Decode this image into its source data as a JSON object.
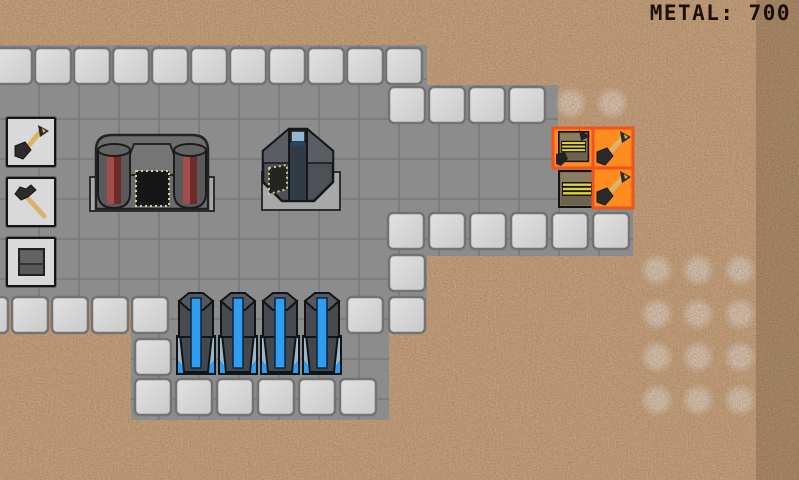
{
  "hud": {
    "metal_label": "METAL:",
    "metal_value": "700"
  },
  "colors": {
    "dirt": "#6b4a28",
    "floor": "#8c8c8c",
    "wall": "#d9d9d9",
    "order_fill": "#ff8c1e",
    "order_border": "#f1531f",
    "liquid_blue": "#2e9df2",
    "ore_gray": "#b8b8bd",
    "factory_red": "#a34c4c",
    "conveyor_yellow": "#e3d42f"
  },
  "toolbar": {
    "buttons": [
      {
        "id": "dig-tool",
        "icon": "shovel-icon"
      },
      {
        "id": "build-tool",
        "icon": "hammer-icon"
      },
      {
        "id": "wall-tool",
        "icon": "block-icon"
      }
    ]
  },
  "world": {
    "wall_rows": [
      {
        "x": -4,
        "y": 48,
        "n": 11,
        "pitch": 39
      },
      {
        "x": 389,
        "y": 87,
        "n": 4,
        "pitch": 40
      },
      {
        "x": 388,
        "y": 213,
        "n": 6,
        "pitch": 41
      },
      {
        "x": -28,
        "y": 297,
        "n": 5,
        "pitch": 40
      },
      {
        "x": 135,
        "y": 339,
        "n": 1,
        "pitch": 40
      },
      {
        "x": 135,
        "y": 379,
        "n": 6,
        "pitch": 41
      },
      {
        "x": 347,
        "y": 297,
        "n": 2,
        "pitch": 42
      },
      {
        "x": 389,
        "y": 255,
        "n": 1,
        "pitch": 40
      }
    ],
    "floor_rects": [
      {
        "x": 0,
        "y": 45,
        "w": 427,
        "h": 256
      },
      {
        "x": 385,
        "y": 85,
        "w": 173,
        "h": 130
      },
      {
        "x": 383,
        "y": 208,
        "w": 250,
        "h": 48
      },
      {
        "x": 131,
        "y": 294,
        "w": 258,
        "h": 126
      },
      {
        "x": 553,
        "y": 166,
        "w": 40,
        "h": 47
      }
    ],
    "ore_deposits": [
      {
        "x": 571,
        "y": 103
      },
      {
        "x": 612,
        "y": 103
      },
      {
        "x": 657,
        "y": 270
      },
      {
        "x": 698,
        "y": 270
      },
      {
        "x": 740,
        "y": 270
      },
      {
        "x": 657,
        "y": 314
      },
      {
        "x": 698,
        "y": 314
      },
      {
        "x": 740,
        "y": 314
      },
      {
        "x": 657,
        "y": 357
      },
      {
        "x": 698,
        "y": 357
      },
      {
        "x": 740,
        "y": 357
      },
      {
        "x": 657,
        "y": 400
      },
      {
        "x": 698,
        "y": 400
      },
      {
        "x": 740,
        "y": 400
      }
    ],
    "tanks": [
      {
        "x": 175,
        "y": 290
      },
      {
        "x": 217,
        "y": 290
      },
      {
        "x": 259,
        "y": 290
      },
      {
        "x": 301,
        "y": 290
      }
    ],
    "buildings": [
      {
        "type": "factory",
        "x": 88,
        "y": 130
      },
      {
        "type": "core",
        "x": 256,
        "y": 126
      },
      {
        "type": "conveyor",
        "x": 558,
        "y": 170
      }
    ],
    "build_orders": [
      {
        "type": "conveyor",
        "x": 553,
        "y": 128
      },
      {
        "type": "dig",
        "x": 593,
        "y": 128
      },
      {
        "type": "dig",
        "x": 593,
        "y": 168
      }
    ]
  }
}
